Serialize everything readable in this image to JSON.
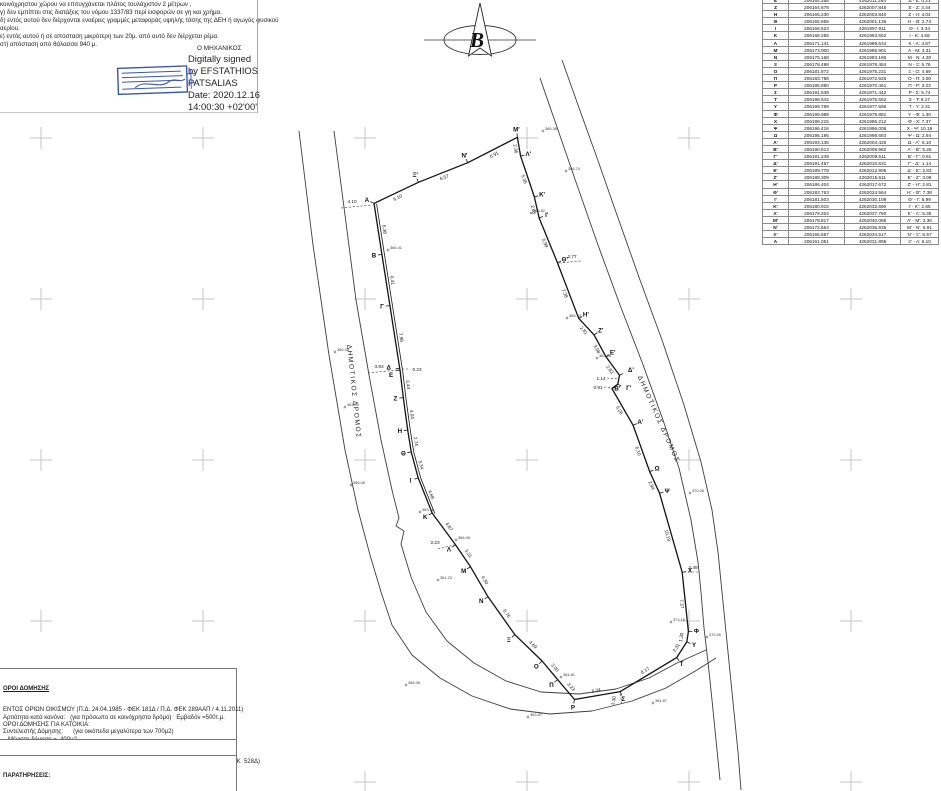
{
  "top_notes": {
    "lines": [
      "κοινόχρηστου χώρου να επιτυγχάνεται πλάτος τουλάχιστον 2 μέτρων ,",
      "γ) δεν εμπίπτει στις διατάξεις του νόμου 1337/83 περί εισφορών σε γη και χρήμα.",
      "δ) εντός αυτού δεν διέρχονται εναέριες γραμμές μεταφοράς υψηλής τάσης της ΔΕΗ ή αγωγός φυσικού",
      "αερίου.",
      "ε) εντός αυτού ή σε απόσταση μικρότερη των 20μ. από αυτό δεν διέρχεται ρέμα.",
      "στ) απόσταση από θάλασσα 940 μ."
    ],
    "engineer_label": "Ο ΜΗΧΑΝΙΚΟΣ",
    "signature_lines": [
      "Digitally signed",
      "by EFSTATHIOS",
      "PATSALIAS",
      "Date: 2020.12.16",
      "14:00:30 +02'00'"
    ],
    "stamp_color": "#3a56b4"
  },
  "north_arrow": {
    "letter": "B"
  },
  "coordinate_table": {
    "rows": [
      [
        "Ε",
        "206164.268",
        "4262011.264",
        "Δ - Ε: 0.23"
      ],
      [
        "Ζ",
        "206164.678",
        "4262007.845",
        "Ε - Ζ: 3.44"
      ],
      [
        "Η",
        "206165.230",
        "4262003.840",
        "Ζ - Η: 4.04"
      ],
      [
        "Θ",
        "206165.665",
        "4262001.135",
        "Η - Θ: 2.74"
      ],
      [
        "Ι",
        "206166.523",
        "4261997.911",
        "Θ - Ι: 3.34"
      ],
      [
        "Κ",
        "206168.255",
        "4261993.552",
        "Ι - Κ: 4.69"
      ],
      [
        "Λ",
        "206171.141",
        "4261989.634",
        "Κ - Λ: 4.87"
      ],
      [
        "Μ",
        "206173.000",
        "4261986.901",
        "Λ - Μ: 3.31"
      ],
      [
        "Ν",
        "206175.168",
        "4261983.186",
        "Μ - Ν: 4.30"
      ],
      [
        "Ξ",
        "206178.498",
        "4261978.484",
        "Ν - Ξ: 5.76"
      ],
      [
        "Ο",
        "206181.872",
        "4261975.231",
        "Ξ - Ο: 4.69"
      ],
      [
        "Π",
        "206183.788",
        "4261972.926",
        "Ο - Π: 3.00"
      ],
      [
        "Ρ",
        "206185.880",
        "4261970.461",
        "Π - Ρ: 3.23"
      ],
      [
        "Σ",
        "206191.539",
        "4261971.442",
        "Ρ - Σ: 5.74"
      ],
      [
        "Τ",
        "206198.542",
        "4261975.652",
        "Σ - Τ: 8.17"
      ],
      [
        "Υ",
        "206199.789",
        "4261977.596",
        "Τ - Υ: 2.31"
      ],
      [
        "Φ",
        "206199.988",
        "4261978.881",
        "Υ - Φ: 1.30"
      ],
      [
        "Χ",
        "206199.215",
        "4261986.212",
        "Φ - Χ: 7.37"
      ],
      [
        "Ψ",
        "206196.416",
        "4261996.006",
        "Χ - Ψ: 10.19"
      ],
      [
        "Ω",
        "206195.195",
        "4261998.683",
        "Ψ - Ω: 2.94"
      ],
      [
        "Α'",
        "206193.136",
        "4262004.425",
        "Ω - Α': 6.10"
      ],
      [
        "Β'",
        "206190.513",
        "4262008.982",
        "Α' - Β': 5.26"
      ],
      [
        "Γ'",
        "206191.249",
        "4262009.511",
        "Β' - Γ': 0.91"
      ],
      [
        "Δ'",
        "206191.457",
        "4262010.631",
        "Γ' - Δ': 1.14"
      ],
      [
        "Ε'",
        "206189.779",
        "4262012.905",
        "Δ' - Ε': 2.83"
      ],
      [
        "Ζ'",
        "206188.309",
        "4262015.611",
        "Ε' - Ζ': 3.08"
      ],
      [
        "Η'",
        "206186.404",
        "4262017.672",
        "Ζ' - Η': 2.81"
      ],
      [
        "Θ'",
        "206183.763",
        "4262024.564",
        "Η' - Θ': 7.38"
      ],
      [
        "Ι'",
        "206181.503",
        "4262030.108",
        "Θ' - Ι': 5.99"
      ],
      [
        "Κ'",
        "206180.915",
        "4262032.690",
        "Ι' - Κ': 2.65"
      ],
      [
        "Λ'",
        "206179.204",
        "4262037.760",
        "Κ' - Λ': 5.35"
      ],
      [
        "Μ'",
        "206178.817",
        "4262040.085",
        "Λ' - Μ': 2.36"
      ],
      [
        "Ν'",
        "206172.664",
        "4262036.935",
        "Μ' - Ν': 6.91"
      ],
      [
        "Ξ'",
        "206166.557",
        "4262034.517",
        "Ν' - Ξ': 6.57"
      ],
      [
        "Α",
        "206161.051",
        "4262031.895",
        "Ξ' - Α: 6.10"
      ]
    ]
  },
  "survey": {
    "polygon": [
      {
        "n": "Α",
        "e": 206161.051,
        "nn": 4262031.895,
        "d": "6.38"
      },
      {
        "n": "Β",
        "e": 206162.034,
        "nn": 4262025.59,
        "d": "6.41"
      },
      {
        "n": "Γ",
        "e": 206163.021,
        "nn": 4262019.26,
        "d": "7.98"
      },
      {
        "n": "Δ",
        "e": 206164.233,
        "nn": 4262011.491,
        "d": "0.23",
        "tiny": true,
        "ldx": -3,
        "ldy": -2
      },
      {
        "n": "Ε",
        "e": 206164.268,
        "nn": 4262011.264,
        "d": "3.44",
        "ldx": -1,
        "ldy": 4
      },
      {
        "n": "Ζ",
        "e": 206164.678,
        "nn": 4262007.845,
        "d": "4.04"
      },
      {
        "n": "Η",
        "e": 206165.23,
        "nn": 4262003.84,
        "d": "2.74"
      },
      {
        "n": "Θ",
        "e": 206165.665,
        "nn": 4262001.135,
        "d": "3.34"
      },
      {
        "n": "Ι",
        "e": 206166.523,
        "nn": 4261997.911,
        "d": "4.69"
      },
      {
        "n": "Κ",
        "e": 206168.255,
        "nn": 4261993.552,
        "d": "4.87"
      },
      {
        "n": "Λ",
        "e": 206171.141,
        "nn": 4261989.634,
        "d": "3.31"
      },
      {
        "n": "Μ",
        "e": 206173.0,
        "nn": 4261986.901,
        "d": "4.30"
      },
      {
        "n": "Ν",
        "e": 206175.168,
        "nn": 4261983.186,
        "d": "5.76"
      },
      {
        "n": "Ξ",
        "e": 206178.498,
        "nn": 4261978.484,
        "d": "4.69"
      },
      {
        "n": "Ο",
        "e": 206181.872,
        "nn": 4261975.231,
        "d": "3.00"
      },
      {
        "n": "Π",
        "e": 206183.788,
        "nn": 4261972.926,
        "d": "3.23"
      },
      {
        "n": "Ρ",
        "e": 206185.88,
        "nn": 4261970.461,
        "d": "5.74"
      },
      {
        "n": "Σ",
        "e": 206191.539,
        "nn": 4261971.442,
        "d": "8.17"
      },
      {
        "n": "Τ",
        "e": 206198.542,
        "nn": 4261975.652,
        "d": "2.31"
      },
      {
        "n": "Υ",
        "e": 206199.789,
        "nn": 4261977.596,
        "d": "1.30"
      },
      {
        "n": "Φ",
        "e": 206199.988,
        "nn": 4261978.881,
        "d": "7.37"
      },
      {
        "n": "Χ",
        "e": 206199.215,
        "nn": 4261986.212,
        "d": "10.19"
      },
      {
        "n": "Ψ",
        "e": 206196.416,
        "nn": 4261996.006,
        "d": "2.94"
      },
      {
        "n": "Ω",
        "e": 206195.195,
        "nn": 4261998.683,
        "d": "6.10"
      },
      {
        "n": "Α'",
        "e": 206193.136,
        "nn": 4262004.425,
        "d": "5.26"
      },
      {
        "n": "Β'",
        "e": 206190.513,
        "nn": 4262008.982,
        "d": "0.91",
        "tiny": true,
        "ldx": -2,
        "ldy": 3
      },
      {
        "n": "Γ'",
        "e": 206191.249,
        "nn": 4262009.511,
        "d": "1.14",
        "tiny": true,
        "ldx": 4,
        "ldy": 0
      },
      {
        "n": "Δ'",
        "e": 206191.457,
        "nn": 4262010.631,
        "d": "2.83",
        "ldx": 4,
        "ldy": -2
      },
      {
        "n": "Ε'",
        "e": 206189.779,
        "nn": 4262012.905,
        "d": "3.08"
      },
      {
        "n": "Ζ'",
        "e": 206188.309,
        "nn": 4262015.611,
        "d": "2.81"
      },
      {
        "n": "Η'",
        "e": 206186.404,
        "nn": 4262017.672,
        "d": "7.38"
      },
      {
        "n": "Θ'",
        "e": 206183.763,
        "nn": 4262024.564,
        "d": "5.99"
      },
      {
        "n": "Ι'",
        "e": 206181.503,
        "nn": 4262030.108,
        "d": "2.65"
      },
      {
        "n": "Κ'",
        "e": 206180.915,
        "nn": 4262032.69,
        "d": "5.35"
      },
      {
        "n": "Λ'",
        "e": 206179.204,
        "nn": 4262037.76,
        "d": "2.36"
      },
      {
        "n": "Μ'",
        "e": 206178.817,
        "nn": 4262040.085,
        "d": "6.91"
      },
      {
        "n": "Ν'",
        "e": 206172.664,
        "nn": 4262036.935,
        "d": "6.57"
      },
      {
        "n": "Ξ'",
        "e": 206166.557,
        "nn": 4262034.517,
        "d": "6.10"
      }
    ],
    "double_line_from": 0,
    "double_line_to": 9
  },
  "drawing": {
    "render": {
      "scale": 8.075,
      "e0": 206180,
      "n0": 4262040,
      "px0": 527,
      "py0": 138
    },
    "grid": {
      "xs": [
        41,
        203,
        365,
        527,
        689,
        851
      ],
      "ys": [
        138,
        299,
        460,
        621,
        782
      ]
    },
    "roads": [
      {
        "name": "road-edge-west-outer",
        "pts": [
          [
            299,
            131
          ],
          [
            313,
            245
          ],
          [
            329,
            355
          ],
          [
            345,
            450
          ],
          [
            358,
            510
          ],
          [
            370,
            555
          ],
          [
            381,
            592
          ],
          [
            392,
            625
          ],
          [
            412,
            655
          ],
          [
            440,
            678
          ],
          [
            472,
            696
          ],
          [
            510,
            709
          ],
          [
            550,
            714
          ],
          [
            592,
            711
          ],
          [
            632,
            701
          ],
          [
            666,
            688
          ],
          [
            697,
            670
          ],
          [
            716,
            658
          ]
        ]
      },
      {
        "name": "road-edge-west-inner",
        "pts": [
          [
            334,
            131
          ],
          [
            345,
            215
          ],
          [
            356,
            300
          ],
          [
            369,
            375
          ],
          [
            381,
            440
          ],
          [
            392,
            490
          ],
          [
            399,
            518
          ],
          [
            396,
            526
          ],
          [
            404,
            531
          ],
          [
            401,
            544
          ],
          [
            411,
            577
          ],
          [
            426,
            612
          ],
          [
            447,
            641
          ],
          [
            474,
            663
          ],
          [
            506,
            681
          ],
          [
            541,
            692
          ],
          [
            579,
            694
          ],
          [
            616,
            689
          ],
          [
            649,
            678
          ],
          [
            677,
            663
          ],
          [
            706,
            650
          ]
        ]
      },
      {
        "name": "road-edge-east-inner",
        "pts": [
          [
            540,
            78
          ],
          [
            558,
            130
          ],
          [
            577,
            185
          ],
          [
            598,
            245
          ],
          [
            620,
            305
          ],
          [
            642,
            362
          ],
          [
            663,
            420
          ],
          [
            679,
            468
          ],
          [
            691,
            520
          ],
          [
            698,
            562
          ],
          [
            701,
            592
          ],
          [
            704,
            628
          ],
          [
            708,
            662
          ],
          [
            712,
            700
          ],
          [
            716,
            740
          ],
          [
            720,
            780
          ]
        ]
      },
      {
        "name": "road-edge-east-outer",
        "pts": [
          [
            562,
            60
          ],
          [
            578,
            105
          ],
          [
            596,
            155
          ],
          [
            617,
            215
          ],
          [
            640,
            280
          ],
          [
            662,
            340
          ],
          [
            684,
            405
          ],
          [
            701,
            462
          ],
          [
            712,
            510
          ],
          [
            718,
            552
          ],
          [
            722,
            592
          ],
          [
            726,
            632
          ],
          [
            730,
            672
          ],
          [
            734,
            712
          ],
          [
            738,
            752
          ],
          [
            741,
            790
          ]
        ]
      }
    ],
    "road_labels": [
      {
        "text": "ΔΗΜΟΤΙΚΟΣ ΔΡΟΜΟΣ",
        "x": 352,
        "y": 392,
        "rot": 84
      },
      {
        "text": "ΔΗΜΟΤΙΚΟΣ ΔΡΟΜΟΣ",
        "x": 657,
        "y": 420,
        "rot": 66
      }
    ],
    "leaders": [
      {
        "t": "4.10",
        "x1": 341,
        "y1": 208,
        "x2": 372,
        "y2": 205,
        "lx": 352,
        "ly": 203,
        "rot": 0
      },
      {
        "t": "3.93",
        "x1": 368,
        "y1": 373,
        "x2": 398,
        "y2": 370,
        "lx": 379,
        "ly": 368,
        "rot": 0
      },
      {
        "t": "2.23",
        "x1": 438,
        "y1": 549,
        "x2": 454,
        "y2": 545,
        "lx": 435,
        "ly": 544,
        "rot": 0
      },
      {
        "t": "2.77",
        "x1": 559,
        "y1": 263,
        "x2": 581,
        "y2": 261,
        "lx": 572,
        "ly": 258,
        "rot": 0
      },
      {
        "t": "2.49",
        "x1": 684,
        "y1": 572,
        "x2": 700,
        "y2": 572,
        "lx": 693,
        "ly": 569,
        "rot": 0
      },
      {
        "t": "1.30",
        "x1": 620,
        "y1": 694,
        "x2": 622,
        "y2": 704,
        "lx": 615,
        "ly": 701,
        "rot": -78
      },
      {
        "t": "0.23",
        "x1": 402,
        "y1": 369,
        "x2": 410,
        "y2": 369,
        "lx": 417,
        "ly": 371,
        "rot": 0
      },
      {
        "t": "0.91",
        "x1": 604,
        "y1": 387,
        "x2": 613,
        "y2": 388,
        "lx": 598,
        "ly": 389,
        "rot": 0
      },
      {
        "t": "1.14",
        "x1": 607,
        "y1": 378,
        "x2": 618,
        "y2": 379,
        "lx": 601,
        "ly": 380,
        "rot": 0
      }
    ],
    "spot_elevations": [
      {
        "v": "366.36",
        "x": 543,
        "y": 131
      },
      {
        "v": "366.74",
        "x": 566,
        "y": 171
      },
      {
        "v": "365.82",
        "x": 531,
        "y": 213
      },
      {
        "v": "365.74",
        "x": 567,
        "y": 318
      },
      {
        "v": "362.06",
        "x": 597,
        "y": 358
      },
      {
        "v": "370.06",
        "x": 690,
        "y": 493
      },
      {
        "v": "371.16",
        "x": 671,
        "y": 622
      },
      {
        "v": "370.06",
        "x": 707,
        "y": 637
      },
      {
        "v": "364.81",
        "x": 561,
        "y": 677
      },
      {
        "v": "363.87",
        "x": 528,
        "y": 717
      },
      {
        "v": "364.87",
        "x": 653,
        "y": 703
      },
      {
        "v": "366.08",
        "x": 335,
        "y": 352
      },
      {
        "v": "363.04",
        "x": 345,
        "y": 407
      },
      {
        "v": "366.06",
        "x": 351,
        "y": 485
      },
      {
        "v": "363.16",
        "x": 420,
        "y": 512
      },
      {
        "v": "361.23",
        "x": 438,
        "y": 580
      },
      {
        "v": "366.06",
        "x": 456,
        "y": 540
      },
      {
        "v": "366.41",
        "x": 388,
        "y": 250
      },
      {
        "v": "366.06",
        "x": 406,
        "y": 685
      }
    ]
  },
  "regulations": {
    "heading": "ΟΡΟΙ ΔΟΜΗΣΗΣ",
    "lines": [
      "ΕΝΤΟΣ ΟΡΙΩΝ ΟΙΚΙΣΜΟΥ (Π.Δ. 24.04.1985 - ΦΕΚ 181Δ / Π.Δ. ΦΕΚ 289ΑΑΠ / 4.11.2011)",
      "Αρτιότητα κατά κανόνα:   (για πρόσωπο σε κοινόχρηστο δρόμο)   Εμβαδόν =500τ.μ.",
      "ΟΡΟΙ ΔΟΜΗΣΗΣ ΓΙΑ ΚΑΤΟΙΚΙΑ:",
      "Συντελεστής Δόμησης:      (για οικόπεδα μεγαλύτερα των 700μ2)",
      "   Μέγιστη δόμηση =  400μ2",
      "Ύψος κτίσματος:             7.50μ (δύο όροφοι)",
      "Κάλυψη:                         60%",
      "ΚΑΘΟΡΙΣΜΟΣ ΕΙΔΙΚΩΝ ΟΡΩΝ ΚΑΙ ΠΕΡΙΟΡΙΣΜΩΝ ΔΟΜΗΣΗΣ  (Π.Δ. 29.10.1982 - ΦΕΚ  528Δ)"
    ]
  },
  "area": {
    "label": "ΕΜΒΑΔΟΝ ΟΙΚΟΠΕΔΟΥ",
    "subscript": "Α,Β,Γ,...,Χ,Ψ,Ω,Α',Β',Γ',...,Μ',Ν',Ξ',Α",
    "value": "= 1534.15 μ2"
  },
  "remarks": {
    "heading": "ΠΑΡΑΤΗΡΗΣΕΙΣ:",
    "lines": [
      "    Το διάγραμμα είναι ενταγμένο στο κρατικό σύστημα συντεταγμένων  ΕΓΣΑ '87",
      "    Οι διαστάσεις και τα εμβαδά υπολογίσθηκαν αναλυτικά από τις συν/νες των κορυφών",
      "    Οι συντεταγμένες που αναφέρονται στο Τοπογραφικό Διάγραμμα είναι στο Ελληνικό Γεωδαιτικό",
      "    Σύστημα Αναφοράς 1987 (Ε.Γ.Σ.Α. '87). Έγινε χρήση εικονικού σταθμού του δικτυακού Δικτύου"
    ]
  }
}
